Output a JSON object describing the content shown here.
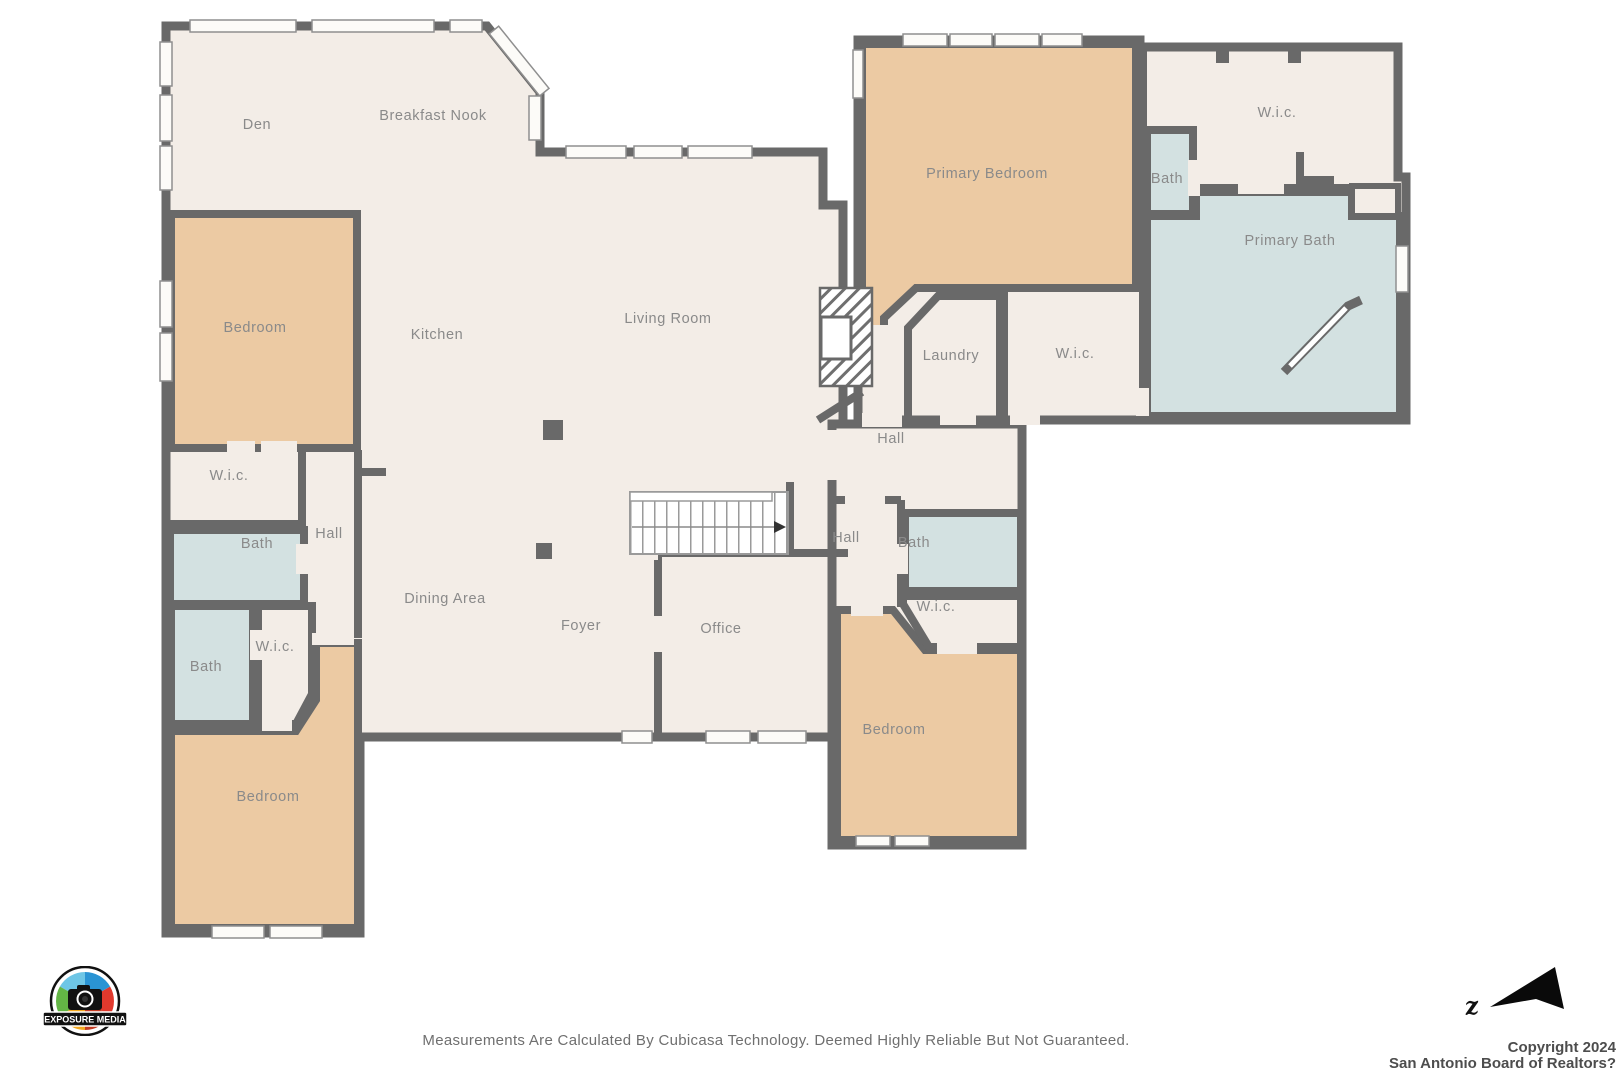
{
  "plan": {
    "rooms": [
      {
        "label": "Den"
      },
      {
        "label": "Breakfast Nook"
      },
      {
        "label": "Bedroom"
      },
      {
        "label": "Kitchen"
      },
      {
        "label": "Living Room"
      },
      {
        "label": "Primary Bedroom"
      },
      {
        "label": "W.i.c."
      },
      {
        "label": "Bath"
      },
      {
        "label": "Primary Bath"
      },
      {
        "label": "Laundry"
      },
      {
        "label": "W.i.c."
      },
      {
        "label": "Hall"
      },
      {
        "label": "W.i.c."
      },
      {
        "label": "Bath"
      },
      {
        "label": "Hall"
      },
      {
        "label": "Bath"
      },
      {
        "label": "W.i.c."
      },
      {
        "label": "Dining Area"
      },
      {
        "label": "Foyer"
      },
      {
        "label": "Office"
      },
      {
        "label": "Hall"
      },
      {
        "label": "Bath"
      },
      {
        "label": "W.i.c."
      },
      {
        "label": "Bedroom"
      },
      {
        "label": "Bedroom"
      }
    ],
    "colors": {
      "wall": "#696969",
      "floor": "#f3ede7",
      "bedroom_fill": "#eccaa3",
      "bath_fill": "#d3e1e1",
      "label_text": "#8a8a8a"
    }
  },
  "footer": {
    "disclaimer": "Measurements Are Calculated By Cubicasa Technology. Deemed Highly Reliable But Not Guaranteed."
  },
  "branding": {
    "logo_text": "EXPOSURE MEDIA",
    "copyright_line1": "Copyright 2024",
    "copyright_line2": "San Antonio Board of Realtors?"
  },
  "compass": {
    "label": "z"
  }
}
